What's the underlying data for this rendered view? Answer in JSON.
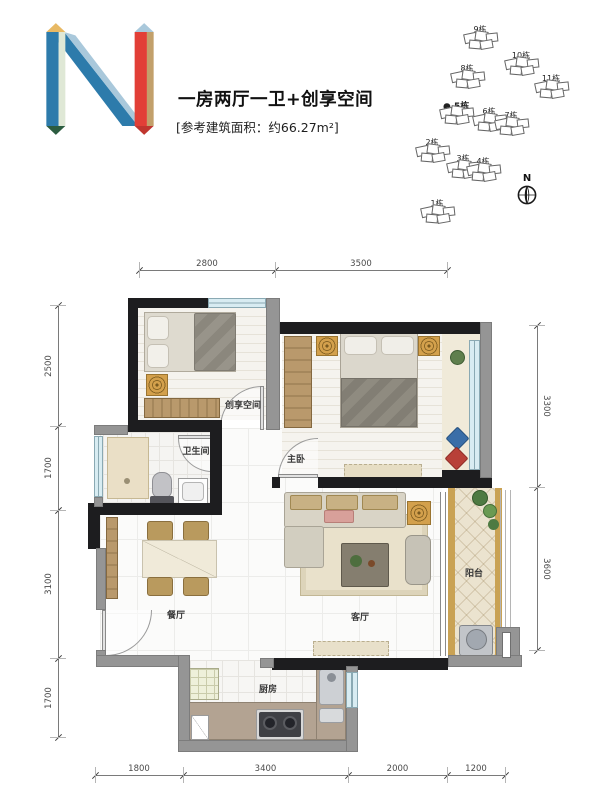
{
  "header": {
    "title": "一房两厅一卫+创享空间",
    "area_note": "[参考建筑面积：约66.27m²]",
    "logo_letter": "N"
  },
  "site_plan": {
    "north_label": "N",
    "buildings": [
      {
        "label": "9栋",
        "x": 480,
        "y": 29,
        "bold": false,
        "marker": false
      },
      {
        "label": "10栋",
        "x": 521,
        "y": 55,
        "bold": false,
        "marker": false
      },
      {
        "label": "8栋",
        "x": 467,
        "y": 68,
        "bold": false,
        "marker": false
      },
      {
        "label": "11栋",
        "x": 551,
        "y": 78,
        "bold": false,
        "marker": false
      },
      {
        "label": "5栋",
        "x": 456,
        "y": 104,
        "bold": true,
        "marker": true
      },
      {
        "label": "6栋",
        "x": 489,
        "y": 111,
        "bold": false,
        "marker": false
      },
      {
        "label": "7栋",
        "x": 511,
        "y": 115,
        "bold": false,
        "marker": false
      },
      {
        "label": "2栋",
        "x": 432,
        "y": 142,
        "bold": false,
        "marker": false
      },
      {
        "label": "3栋",
        "x": 463,
        "y": 158,
        "bold": false,
        "marker": false
      },
      {
        "label": "4栋",
        "x": 483,
        "y": 161,
        "bold": false,
        "marker": false
      },
      {
        "label": "1栋",
        "x": 437,
        "y": 203,
        "bold": false,
        "marker": false
      }
    ]
  },
  "floor_plan": {
    "rooms": [
      {
        "name": "creative-space",
        "label": "创享空间",
        "x": 243,
        "y": 404
      },
      {
        "name": "bathroom",
        "label": "卫生间",
        "x": 196,
        "y": 450
      },
      {
        "name": "master-bedroom",
        "label": "主卧",
        "x": 296,
        "y": 458
      },
      {
        "name": "dining-room",
        "label": "餐厅",
        "x": 176,
        "y": 614
      },
      {
        "name": "living-room",
        "label": "客厅",
        "x": 360,
        "y": 616
      },
      {
        "name": "balcony",
        "label": "阳台",
        "x": 474,
        "y": 572
      },
      {
        "name": "kitchen",
        "label": "厨房",
        "x": 268,
        "y": 688
      }
    ],
    "dimensions": {
      "top": {
        "axis": "h",
        "pos": 270,
        "ticks": [
          139,
          275,
          447
        ],
        "labels": [
          "2800",
          "3500"
        ]
      },
      "bottom": {
        "axis": "h",
        "pos": 775,
        "ticks": [
          95,
          183,
          348,
          447,
          505
        ],
        "labels": [
          "1800",
          "3400",
          "2000",
          "1200"
        ]
      },
      "left": {
        "axis": "v",
        "pos": 58,
        "ticks": [
          305,
          426,
          510,
          658,
          737
        ],
        "labels": [
          "2500",
          "1700",
          "3100",
          "1700"
        ],
        "rot": -90,
        "off": -9
      },
      "right": {
        "axis": "v",
        "pos": 537,
        "ticks": [
          325,
          487,
          650
        ],
        "labels": [
          "3300",
          "3600"
        ],
        "rot": 90,
        "off": 9
      }
    }
  },
  "colors": {
    "wall": "#1d1d1f",
    "wall_light": "#959595",
    "window": "#d8ecf2",
    "wood": "#b3906a",
    "gold": "#d3a04c",
    "balcony_trim": "#c9a254",
    "logo_blue": "#2d7bab",
    "logo_light_blue": "#a9c8db",
    "logo_cream": "#dfe8d6",
    "logo_orange": "#e8b964",
    "logo_dark_green": "#2c5c40",
    "logo_red": "#e23f37",
    "logo_tan": "#c2a06b"
  }
}
